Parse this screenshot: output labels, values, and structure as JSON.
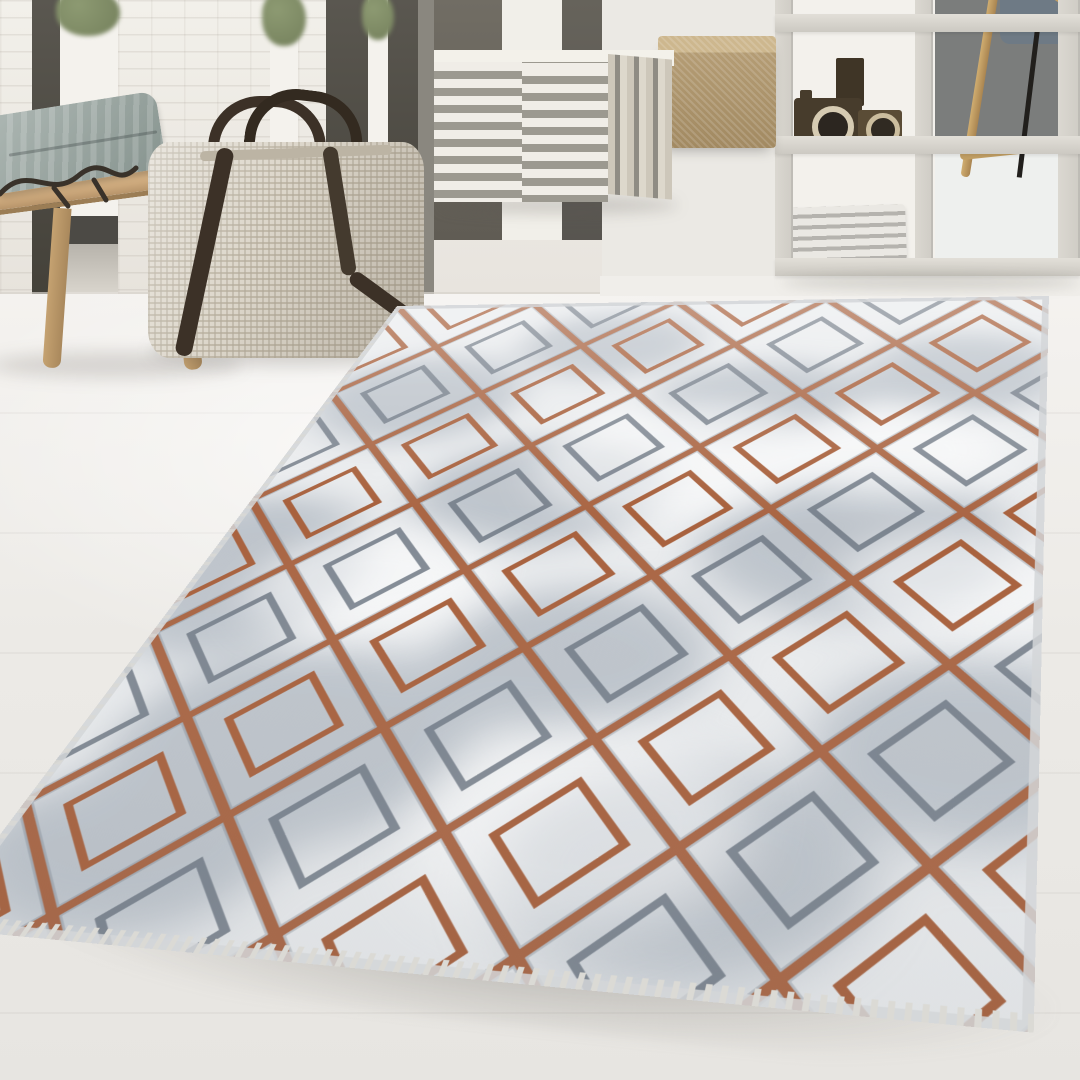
{
  "meta": {
    "description": "Bright interior product photo: a grey marble-effect area rug with a bronze copper diamond lattice pattern lies on a whitewashed wooden floor in front of a white painted brick wall with dark-framed glass doors; styled with a light oak bench holding a grey cushion and a dark branch ornament, a beige woven weekender bag with dark leather straps, a grey-and-white striped cube pouf, a cork cube pouf, and a white cube shelf displaying vintage wooden toy cameras and stacked newspapers, with a blue-grey chair behind it."
  },
  "scene": {
    "objects": [
      {
        "name": "brick-wall",
        "label": "white painted brick wall"
      },
      {
        "name": "glass-doors",
        "label": "floor-to-ceiling glass doors with dark frames"
      },
      {
        "name": "plants",
        "label": "green plants beyond the glazing"
      },
      {
        "name": "wooden-bench",
        "label": "light oak bench"
      },
      {
        "name": "cushion",
        "label": "grey-blue cushion lying on the bench"
      },
      {
        "name": "branch-decor",
        "label": "dark branch ornament on the bench"
      },
      {
        "name": "weekender-bag",
        "label": "beige woven weekender bag with dark leather straps"
      },
      {
        "name": "striped-pouf",
        "label": "grey and white striped cube pouf"
      },
      {
        "name": "cork-pouf",
        "label": "cork cube pouf"
      },
      {
        "name": "cube-shelf",
        "label": "white cube shelving unit"
      },
      {
        "name": "toy-cameras",
        "label": "vintage wooden toy cameras displayed on the shelf"
      },
      {
        "name": "newspapers",
        "label": "stack of folded newspapers on the shelf"
      },
      {
        "name": "chair",
        "label": "blue-grey chair with wooden legs behind the shelf"
      },
      {
        "name": "wood-floor",
        "label": "whitewashed wooden floor"
      },
      {
        "name": "rug",
        "label": "grey marble-effect rug with bronze diamond lattice pattern and short fringe"
      }
    ]
  },
  "rug": {
    "pattern": "diamond lattice at 45 degrees",
    "inner_motifs": [
      "bronze outlined inner diamonds",
      "graphite outlined inner diamonds"
    ],
    "texture": "marbled grey patches on ivory ground",
    "edge": "light selvage with short fringe on the near edge"
  },
  "palette": {
    "copper": "#a8613d",
    "copper-dark": "#7c4226",
    "rug-base": "#eaecee",
    "rug-marble": "#939eaa",
    "rug-line-gray": "#6e7884",
    "selvage": "#d3d6d8",
    "fringe": "#dbdad5",
    "wall-white": "#edeae5",
    "frame-dark": "#504d47",
    "glass-bright": "#f4f2ed",
    "plant-green": "#74805c",
    "wood": "#c7a475",
    "pillow": "#9aa7a7",
    "strap": "#3c3127",
    "bag": "#d0c8b8",
    "stripe-gray": "#9c9990",
    "pouf-white": "#f0ede7",
    "cork": "#b49c74",
    "shelf-frame": "#dbd8d1",
    "shelf-dark": "#7b7d7c",
    "chair-blue": "#6e7a85",
    "stick": "#c19e63",
    "rod-black": "#211f1c",
    "floor": "#f2f0ed"
  }
}
